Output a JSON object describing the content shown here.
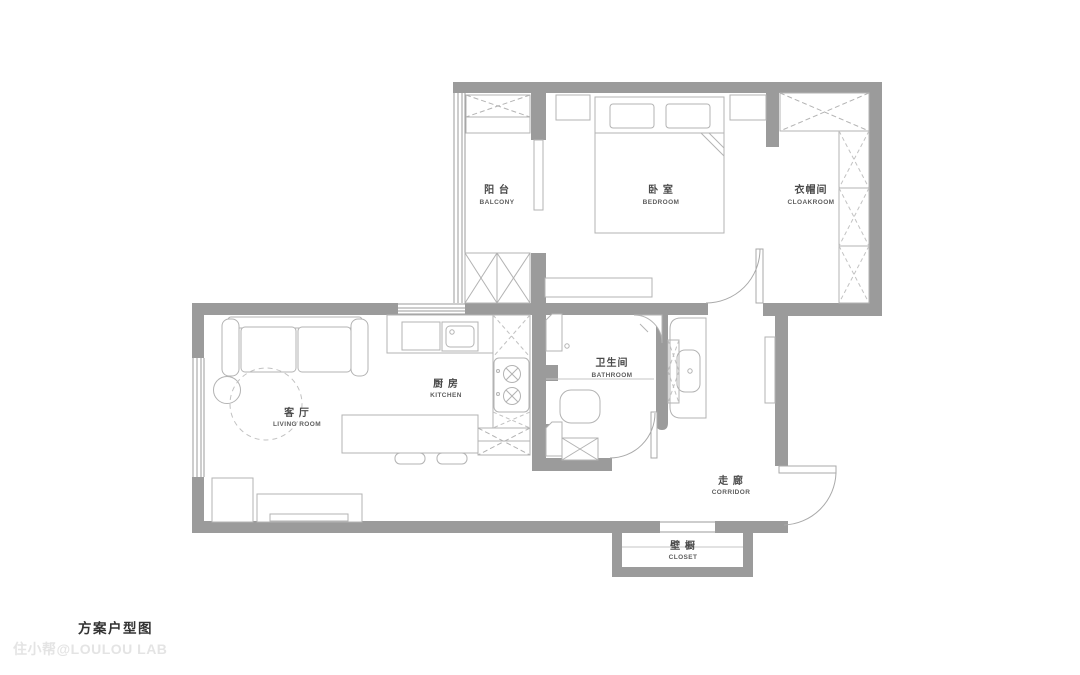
{
  "title": {
    "text": "方案户型图"
  },
  "watermark": {
    "text": "住小帮@LOULOU LAB"
  },
  "rooms": [
    {
      "id": "balcony",
      "zh": "阳 台",
      "en": "BALCONY"
    },
    {
      "id": "bedroom",
      "zh": "卧 室",
      "en": "BEDROOM"
    },
    {
      "id": "cloakroom",
      "zh": "衣帽间",
      "en": "CLOAKROOM"
    },
    {
      "id": "bathroom",
      "zh": "卫生间",
      "en": "BATHROOM"
    },
    {
      "id": "kitchen",
      "zh": "厨 房",
      "en": "KITCHEN"
    },
    {
      "id": "living-room",
      "zh": "客 厅",
      "en": "LIVING ROOM"
    },
    {
      "id": "corridor",
      "zh": "走 廊",
      "en": "CORRIDOR"
    },
    {
      "id": "closet",
      "zh": "壁 橱",
      "en": "CLOSET"
    }
  ],
  "colors": {
    "wall": "#9b9b9b",
    "furniture_line": "#b3b3b3",
    "dash_line": "#c2c2c2",
    "label_text": "#4a4a4a",
    "label_subtext": "#5e5e5e",
    "watermark": "#e4e4e4",
    "background": "#ffffff"
  }
}
